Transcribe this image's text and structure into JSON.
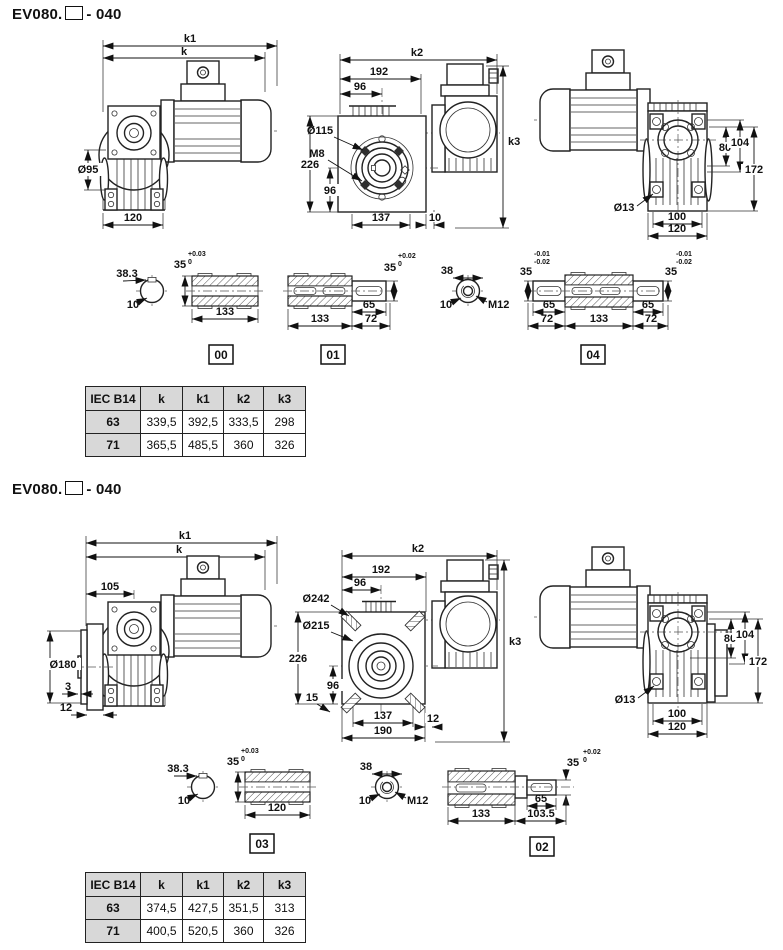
{
  "s1": {
    "title": {
      "model": "EV080.",
      "suffix": "- 040"
    },
    "side": {
      "k1": "k1",
      "k": "k",
      "hub": "Ø95",
      "width": "120"
    },
    "front": {
      "k2": "k2",
      "l192": "192",
      "t96": "96",
      "bc": "Ø115",
      "bolt": "M8",
      "h226": "226",
      "b96": "96",
      "w137": "137",
      "g10": "10",
      "k3": "k3"
    },
    "rear": {
      "v80": "80",
      "v104": "104",
      "v172": "172",
      "hole": "Ø13",
      "w100": "100",
      "w120": "120"
    },
    "key1": {
      "a": "38.3",
      "b": "10"
    },
    "sh00": {
      "bore": "35",
      "th": "+0.03",
      "tl": "0",
      "len": "133",
      "tag": "00"
    },
    "sh01": {
      "len": "133",
      "e65": "65",
      "e72": "72",
      "bore": "35",
      "th": "+0.02",
      "tl": "0",
      "tag": "01"
    },
    "key2": {
      "a": "38",
      "b": "10",
      "thread": "M12"
    },
    "sh04": {
      "lth": "-0.01",
      "ltl": "-0.02",
      "l35": "35",
      "l65": "65",
      "l72": "72",
      "len": "133",
      "r65": "65",
      "r72": "72",
      "r35": "35",
      "rth": "-0.01",
      "rtl": "-0.02",
      "tag": "04"
    },
    "table": {
      "headers": [
        "IEC B14",
        "k",
        "k1",
        "k2",
        "k3"
      ],
      "rows": [
        [
          "63",
          "339,5",
          "392,5",
          "333,5",
          "298"
        ],
        [
          "71",
          "365,5",
          "485,5",
          "360",
          "326"
        ]
      ]
    }
  },
  "s2": {
    "title": {
      "model": "EV080.",
      "suffix": "- 040"
    },
    "side": {
      "k1": "k1",
      "k": "k",
      "l105": "105",
      "flange": "Ø180",
      "p3": "3",
      "p12": "12"
    },
    "front": {
      "k2": "k2",
      "l192": "192",
      "t96": "96",
      "fd": "Ø242",
      "bc": "Ø215",
      "h226": "226",
      "b96": "96",
      "c15": "15",
      "w137": "137",
      "w190": "190",
      "g12": "12",
      "k3": "k3"
    },
    "rear": {
      "v80": "80",
      "v104": "104",
      "v172": "172",
      "hole": "Ø13",
      "w100": "100",
      "w120": "120"
    },
    "key1": {
      "a": "38.3",
      "b": "10"
    },
    "sh03": {
      "bore": "35",
      "th": "+0.03",
      "tl": "0",
      "len": "120",
      "tag": "03"
    },
    "key2": {
      "a": "38",
      "b": "10",
      "thread": "M12"
    },
    "sh02": {
      "len": "133",
      "l1035": "103.5",
      "e65": "65",
      "d35": "35",
      "th": "+0.02",
      "tl": "0",
      "tag": "02"
    },
    "table": {
      "headers": [
        "IEC B14",
        "k",
        "k1",
        "k2",
        "k3"
      ],
      "rows": [
        [
          "63",
          "374,5",
          "427,5",
          "351,5",
          "313"
        ],
        [
          "71",
          "400,5",
          "520,5",
          "360",
          "326"
        ]
      ]
    }
  }
}
